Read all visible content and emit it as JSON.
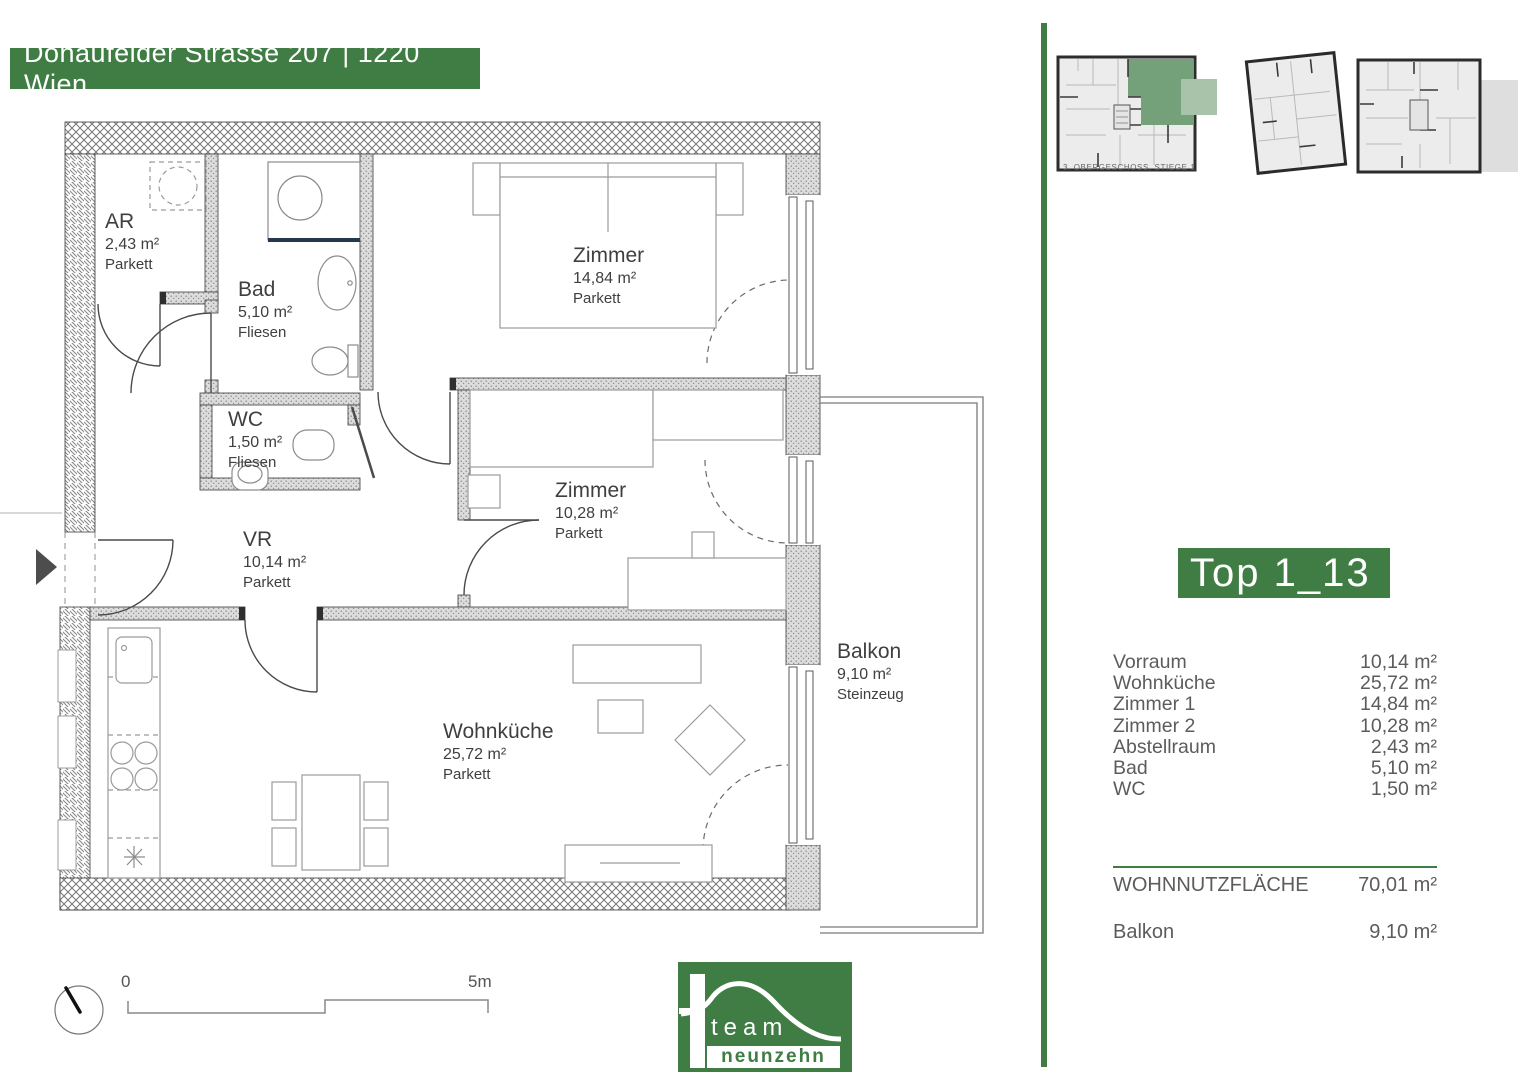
{
  "header": {
    "address_banner": "Donaufelder Strasse 207 | 1220 Wien"
  },
  "overview": {
    "caption": "3. OBERGESCHOSS, STIEGE 1"
  },
  "unit_panel": {
    "unit_label": "Top 1_13",
    "rows": [
      {
        "label": "Vorraum",
        "value": "10,14 m²"
      },
      {
        "label": "Wohnküche",
        "value": "25,72 m²"
      },
      {
        "label": "Zimmer 1",
        "value": "14,84 m²"
      },
      {
        "label": "Zimmer 2",
        "value": "10,28 m²"
      },
      {
        "label": "Abstellraum",
        "value": "2,43 m²"
      },
      {
        "label": "Bad",
        "value": "5,10 m²"
      },
      {
        "label": "WC",
        "value": "1,50 m²"
      }
    ],
    "total": {
      "label": "WOHNNUTZFLÄCHE",
      "value": "70,01 m²"
    },
    "balcony": {
      "label": "Balkon",
      "value": "9,10 m²"
    }
  },
  "floorplan": {
    "rooms": [
      {
        "name": "AR",
        "area": "2,43 m²",
        "floor": "Parkett"
      },
      {
        "name": "Bad",
        "area": "5,10 m²",
        "floor": "Fliesen"
      },
      {
        "name": "WC",
        "area": "1,50 m²",
        "floor": "Fliesen"
      },
      {
        "name": "Zimmer",
        "area": "14,84 m²",
        "floor": "Parkett"
      },
      {
        "name": "Zimmer",
        "area": "10,28 m²",
        "floor": "Parkett"
      },
      {
        "name": "VR",
        "area": "10,14 m²",
        "floor": "Parkett"
      },
      {
        "name": "Wohnküche",
        "area": "25,72 m²",
        "floor": "Parkett"
      },
      {
        "name": "Balkon",
        "area": "9,10 m²",
        "floor": "Steinzeug"
      }
    ],
    "scale_bar": {
      "start": "0",
      "end": "5m"
    }
  },
  "logo": {
    "line1": "team",
    "line2": "neunzehn"
  },
  "colors": {
    "brand_green": "#3f7d44",
    "unit_highlight_green": "#74a179",
    "balcony_highlight_green": "#a9c3aa",
    "wall_dark": "#2d2d2d",
    "text_gray": "#5c5c5c"
  }
}
